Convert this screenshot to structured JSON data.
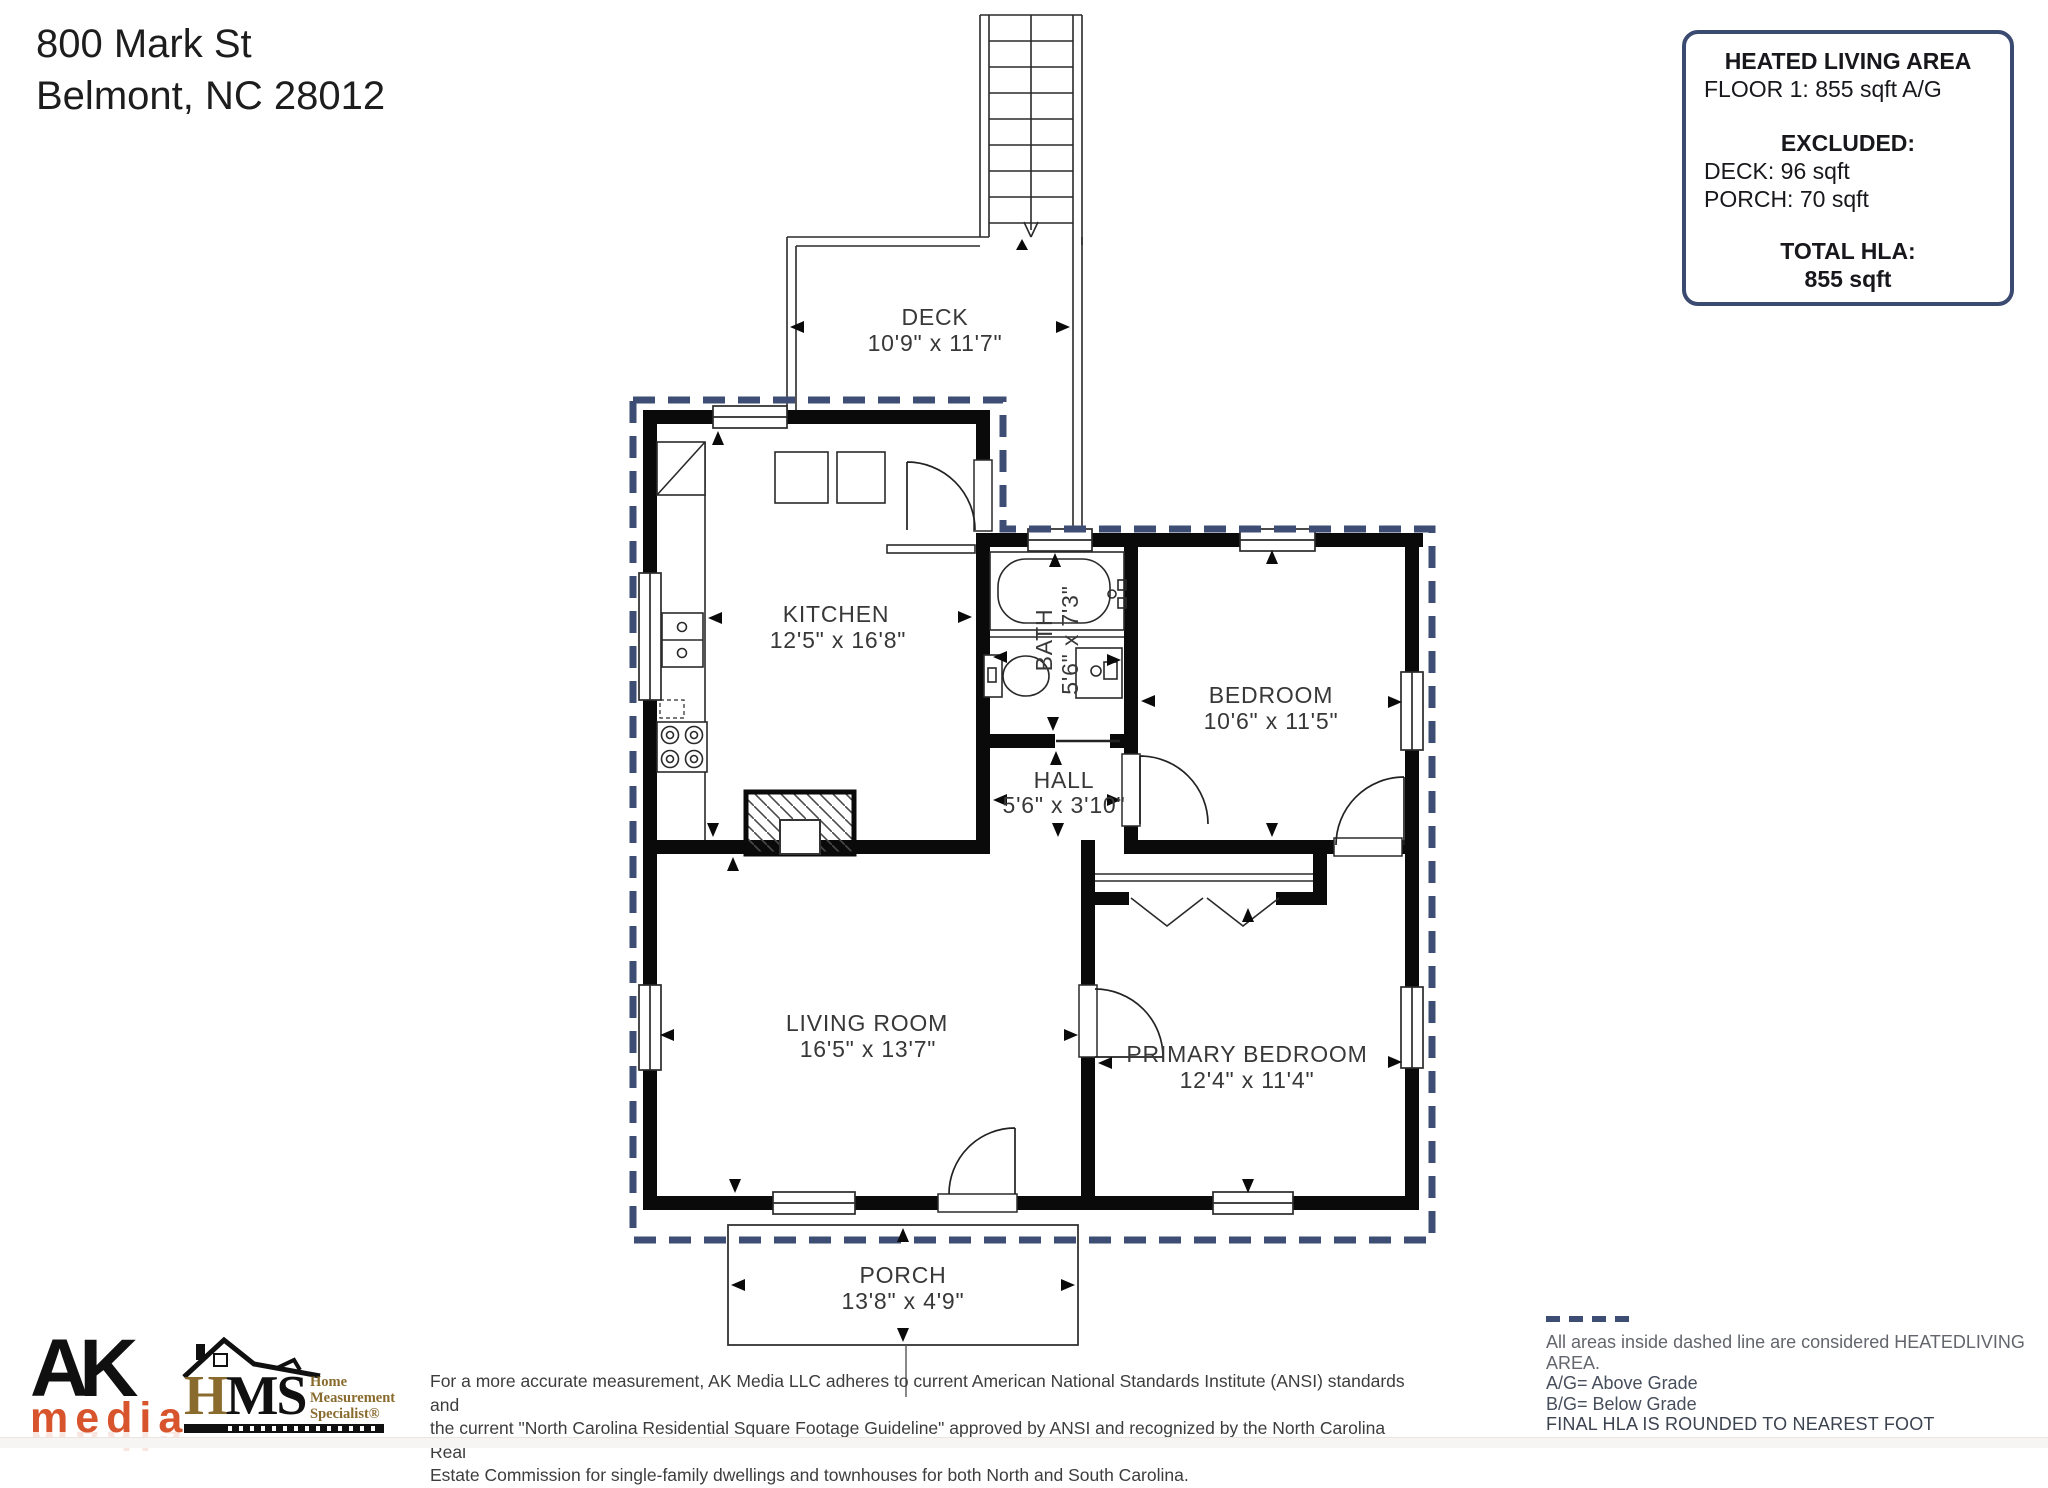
{
  "address": {
    "line1": "800 Mark St",
    "line2": "Belmont, NC  28012"
  },
  "info_box": {
    "title": "HEATED LIVING AREA",
    "floor_line": "FLOOR 1: 855 sqft  A/G",
    "excluded_title": "EXCLUDED:",
    "excluded_items": [
      "DECK: 96 sqft",
      "PORCH: 70 sqft"
    ],
    "total_title": "TOTAL HLA:",
    "total_value": "855 sqft"
  },
  "rooms": {
    "deck": {
      "name": "DECK",
      "dims": "10'9\" x 11'7\""
    },
    "kitchen": {
      "name": "KITCHEN",
      "dims": "12'5\" x 16'8\""
    },
    "bath": {
      "name": "BATH",
      "dims": "5'6\" x 7'3\""
    },
    "bedroom": {
      "name": "BEDROOM",
      "dims": "10'6\" x 11'5\""
    },
    "hall": {
      "name": "HALL",
      "dims": "5'6\" x 3'10\""
    },
    "living_room": {
      "name": "LIVING ROOM",
      "dims": "16'5\" x 13'7\""
    },
    "primary_bedroom": {
      "name": "PRIMARY BEDROOM",
      "dims": "12'4\" x 11'4\""
    },
    "porch": {
      "name": "PORCH",
      "dims": "13'8\" x 4'9\""
    }
  },
  "logos": {
    "ak_top": "AK",
    "ak_bottom": "media",
    "hms_acronym_first": "H",
    "hms_acronym_rest": "MS",
    "hms_sub_line1": "Home",
    "hms_sub_line2": "Measurement",
    "hms_sub_line3": "Specialist®"
  },
  "disclaimer": [
    "For a more accurate measurement, AK Media LLC adheres to current American National Standards Institute (ANSI) standards and",
    "the current \"North Carolina Residential Square Footage Guideline\" approved by ANSI and recognized by the North Carolina Real",
    "Estate Commission for single-family dwellings and townhouses for both North and South Carolina."
  ],
  "legend": {
    "line1": "All areas inside dashed line are considered HEATEDLIVING AREA.",
    "line2": "A/G= Above Grade",
    "line3": "B/G= Below Grade",
    "line4": "FINAL HLA IS ROUNDED TO NEAREST FOOT"
  },
  "colors": {
    "dashed_boundary": "#3e4d73",
    "wall": "#0a0a0a",
    "ak_orange": "#d8542c",
    "hms_bronze": "#8a6b2e",
    "info_border": "#3a4a70"
  }
}
